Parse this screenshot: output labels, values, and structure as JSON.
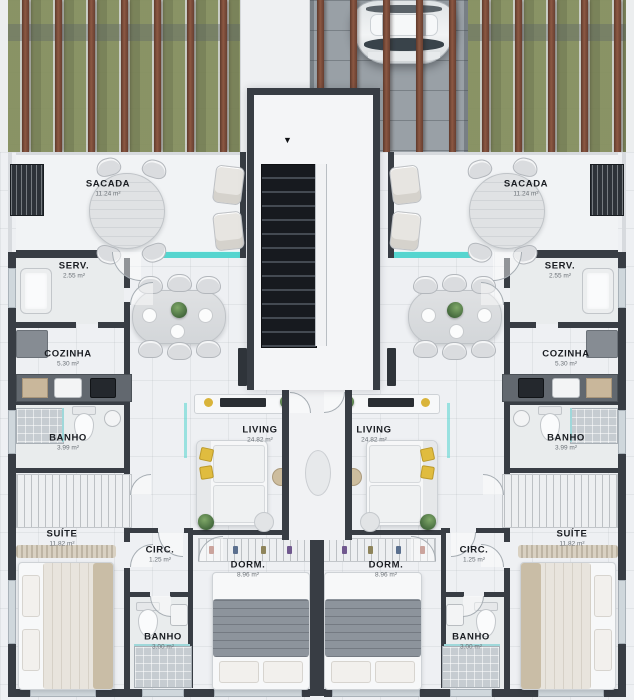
{
  "colors": {
    "wall": "#383d44",
    "floor": "#eef0f3",
    "accent_teal": "#55d5cf",
    "slat_brown": "#7a4a37",
    "moss_green": "#8b9560",
    "stair_dark": "#171a1f"
  },
  "plan": {
    "stair_arrow": "▼"
  },
  "units": {
    "left": {
      "rooms": [
        {
          "name": "SACADA",
          "area": "11.24 m²"
        },
        {
          "name": "SERV.",
          "area": "2.55 m²"
        },
        {
          "name": "COZINHA",
          "area": "5.30 m²"
        },
        {
          "name": "BANHO",
          "area": "3.99 m²"
        },
        {
          "name": "SUÍTE",
          "area": "11.82 m²"
        },
        {
          "name": "CIRC.",
          "area": "1.25 m²"
        },
        {
          "name": "DORM.",
          "area": "8.96 m²"
        },
        {
          "name": "BANHO",
          "area": "3.00 m²"
        },
        {
          "name": "LIVING",
          "area": "24.82 m²"
        }
      ]
    },
    "right": {
      "rooms": [
        {
          "name": "SACADA",
          "area": "11.24 m²"
        },
        {
          "name": "SERV.",
          "area": "2.55 m²"
        },
        {
          "name": "COZINHA",
          "area": "5.30 m²"
        },
        {
          "name": "BANHO",
          "area": "3.99 m²"
        },
        {
          "name": "SUÍTE",
          "area": "11.82 m²"
        },
        {
          "name": "CIRC.",
          "area": "1.25 m²"
        },
        {
          "name": "DORM.",
          "area": "8.96 m²"
        },
        {
          "name": "BANHO",
          "area": "3.00 m²"
        },
        {
          "name": "LIVING",
          "area": "24.82 m²"
        }
      ]
    }
  }
}
